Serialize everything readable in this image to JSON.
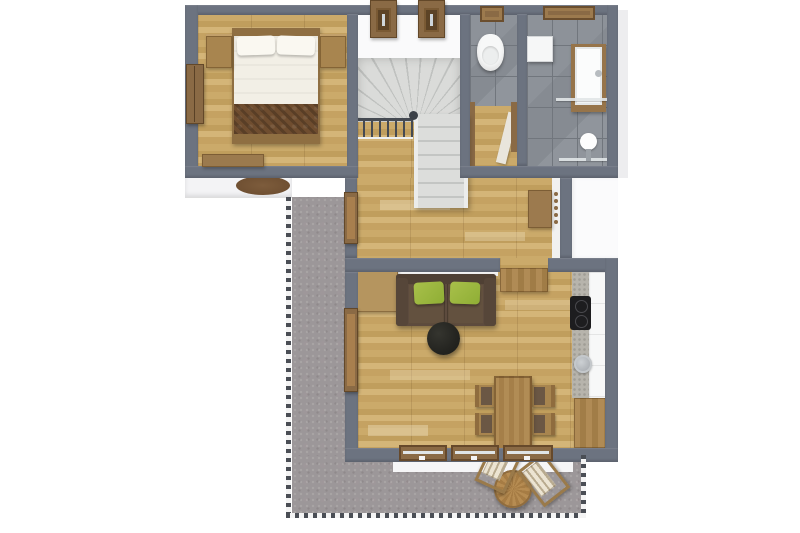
{
  "scene": {
    "title": "3D top-down floor plan of an apartment level with terrace",
    "view": "top-down 3D architectural render",
    "canvas": {
      "width": 800,
      "height": 533
    }
  },
  "palette": {
    "background": "#ffffff",
    "wall_gray": "#6c7380",
    "wood_floor": "#c8a664",
    "wood_furniture": "#a8854f",
    "wood_dark_frame": "#8a6a45",
    "tile_gray": "#8d9299",
    "terrace_carpet": "#9c9799",
    "stair_tread": "#d9dad8",
    "sofa_brown": "#5d4b3e",
    "cushion_green": "#9db63e",
    "bed_linen_white": "#f2efe6",
    "blanket_brown": "#6f4d2f",
    "railing_dark": "#4a4e55",
    "cooktop_black": "#1d1d1f",
    "coffee_table_black": "#242420"
  },
  "rooms": {
    "bedroom": {
      "label": "Bedroom",
      "furniture": [
        "double bed",
        "pillow",
        "pillow",
        "brown bed runner",
        "nightstand left",
        "nightstand right",
        "wardrobe",
        "bench",
        "round rug"
      ]
    },
    "stairs": {
      "label": "Staircase",
      "furniture": [
        "winder staircase",
        "stair railing",
        "newel post",
        "roof window",
        "roof window"
      ]
    },
    "wc": {
      "label": "WC",
      "furniture": [
        "wall-hung toilet",
        "window",
        "door frame",
        "open door"
      ]
    },
    "bathroom": {
      "label": "Bathroom",
      "furniture": [
        "washing machine",
        "washbasin vanity",
        "glass shower partition",
        "shower fitting",
        "window"
      ]
    },
    "hallway": {
      "label": "Hallway",
      "furniture": [
        "coat rack cabinet",
        "wall hooks",
        "terrace door"
      ]
    },
    "living": {
      "label": "Living room",
      "furniture": [
        "two-seat sofa",
        "green cushion",
        "green cushion",
        "round coffee table",
        "sideboard",
        "tall cabinet",
        "dining table",
        "chair",
        "chair",
        "chair",
        "chair",
        "terrace door",
        "window band"
      ]
    },
    "kitchen": {
      "label": "Kitchen",
      "furniture": [
        "stone countertop",
        "white cabinet run",
        "cooktop",
        "round sink",
        "wooden base cabinet"
      ]
    },
    "terrace": {
      "label": "Terrace",
      "furniture": [
        "round bistro table",
        "striped deck chair",
        "striped deck chair",
        "perimeter railing"
      ]
    }
  }
}
